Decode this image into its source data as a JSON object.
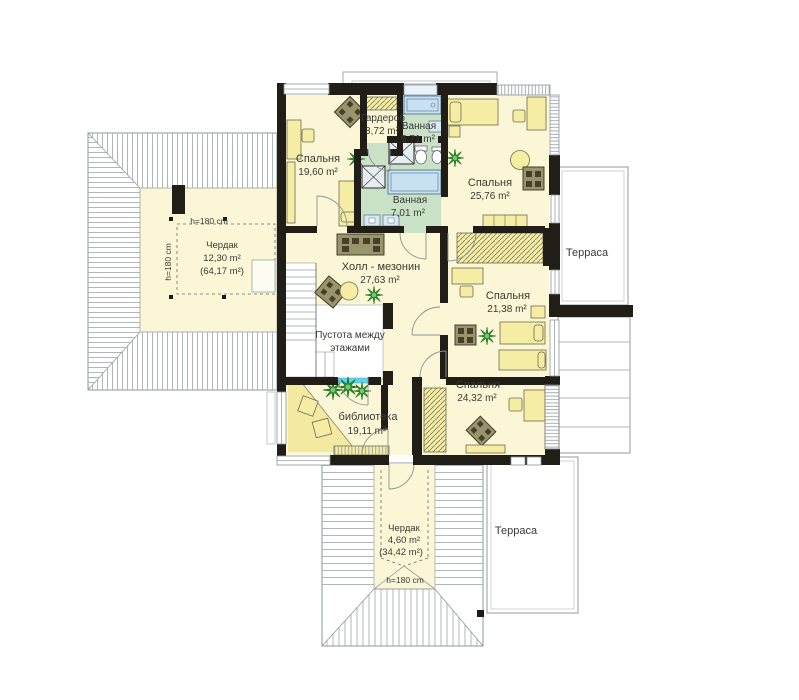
{
  "plan_title": "floor-plan-second-storey",
  "colors": {
    "room_fill": "#FBF7D6",
    "bath_fill": "#C9E2C7",
    "wall": "#211E17",
    "furniture": "#F5EDA4",
    "sofa": "#98956B",
    "plant": "#2E9B2E",
    "glass": "#63D3E8",
    "tub": "#C7E0F2",
    "roof_hatch": "#A7AEB3"
  },
  "rooms": [
    {
      "name": "Спальня",
      "area": "19,60 m²"
    },
    {
      "name": "Гардероб",
      "area": "3,72 m²"
    },
    {
      "name": "Ванная",
      "area": "5,71 m²"
    },
    {
      "name": "Спальня",
      "area": "25,76 m²"
    },
    {
      "name": "Ванная",
      "area": "7,01 m²"
    },
    {
      "name": "Чердак",
      "area": "12,30 m²",
      "area2": "(64,17 m²)"
    },
    {
      "name": "Холл - мезонин",
      "area": "27,63 m²"
    },
    {
      "name": "Терраса"
    },
    {
      "name": "Спальня",
      "area": "21,38 m²"
    },
    {
      "name": "Пустота между",
      "name2": "этажами"
    },
    {
      "name": "Спальня",
      "area": "24,32 m²"
    },
    {
      "name": "библиотека",
      "area": "19,11 m²"
    },
    {
      "name": "Чердак",
      "area": "4,60 m²",
      "area2": "(34,42 m²)"
    },
    {
      "name": "Терраса"
    }
  ],
  "heights": {
    "left_h": "h=180 cm",
    "left_v": "h=180 cm",
    "bottom": "h=180 cm"
  }
}
